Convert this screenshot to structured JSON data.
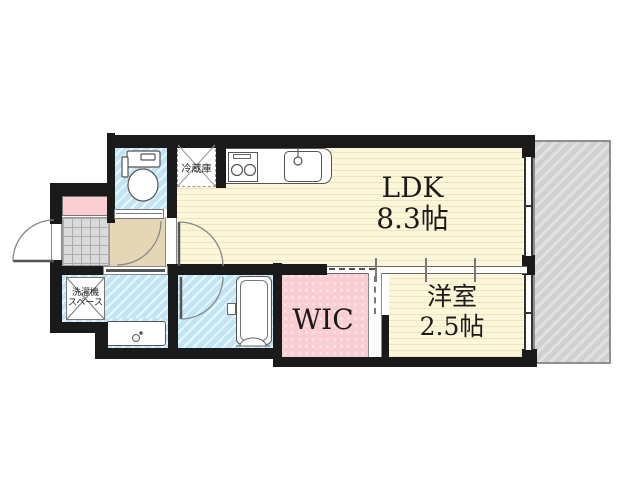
{
  "floorplan": {
    "rooms": {
      "ldk": {
        "name": "LDK",
        "size": "8.3帖"
      },
      "western_room": {
        "name": "洋室",
        "size": "2.5帖"
      },
      "walk_in_closet": {
        "name": "WIC"
      },
      "refrigerator_space": {
        "label": "冷蔵庫"
      },
      "washer_space": {
        "label_line1": "洗濯機",
        "label_line2": "スペース"
      }
    },
    "fixture_icons": [
      "toilet-icon",
      "kitchen-counter-icon",
      "stove-burners-icon",
      "kitchen-sink-icon",
      "bathtub-icon",
      "vanity-sink-icon",
      "entrance-door-arc-icon",
      "room-door-arc-icon",
      "bath-door-arc-icon",
      "sliding-door-icon",
      "window-icon",
      "balcony-hatch-icon",
      "shoe-cabinet-icon",
      "genkan-tile-icon"
    ],
    "colors": {
      "wall": "#1a1a1a",
      "ldk_floor": "#FCF6DA",
      "ldk_stripe": "#EFE5BD",
      "wet_area_floor": "#C2E5F5",
      "wic_floor": "#F9CDD2",
      "hallway_floor": "#E5D7B6",
      "genkan_tile": "#DADADA",
      "balcony": "#D0D0D0"
    }
  }
}
